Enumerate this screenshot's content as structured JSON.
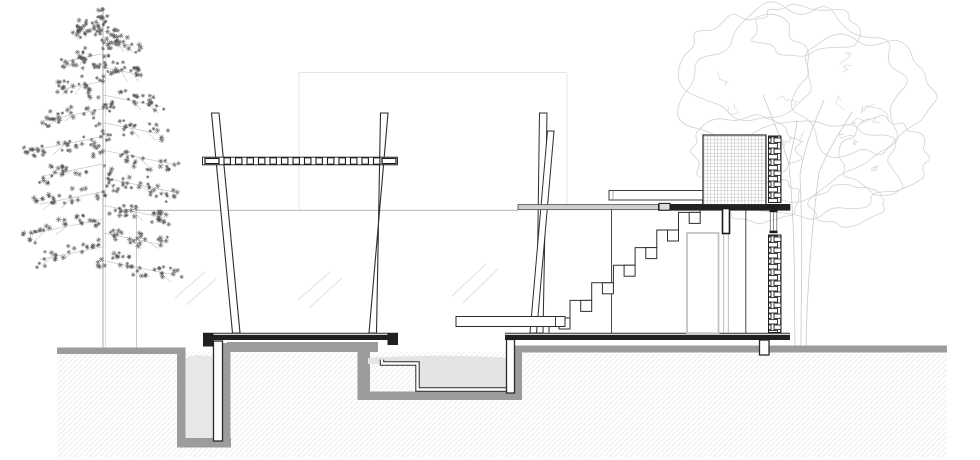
{
  "meta": {
    "title": "architectural-section-drawing",
    "canvas": {
      "width": 980,
      "height": 460,
      "background": "#ffffff"
    }
  },
  "palette": {
    "ink": "#2d2d2d",
    "slab_black": "#202020",
    "ground_gray": "#9c9c9c",
    "pit_fill": "#e7e7e7",
    "water_fill": "#e4e4e4",
    "slab_gray": "#cfcfcf",
    "frame_gray": "#c2c2c2",
    "faint_line": "#e4e4e4",
    "horizon_gray": "#b6b6b6",
    "tree_scatter": "#525252",
    "tree_sketch": "#d2d2d2",
    "hatch_gray": "#ededed"
  },
  "patterns": {
    "grid": {
      "size": 3.4,
      "stroke": "#8a8a8a",
      "width": 0.55
    },
    "brick": {
      "tile_w": 13,
      "tile_h": 11,
      "brick_w": 10,
      "brick_h": 4.4,
      "stroke": "#1f1f1f",
      "width": 0.9
    },
    "hatch": {
      "size": 5.2,
      "stroke": "#ededed",
      "width": 1.1
    }
  },
  "layers": [
    {
      "name": "background-references",
      "items": [
        {
          "n": "backdrop-rect-top-edge",
          "k": "line",
          "x1": 299,
          "y1": 72.5,
          "x2": 567,
          "y2": 72.5,
          "s": "#e4e4e4",
          "w": 1
        },
        {
          "n": "backdrop-rect-left-edge",
          "k": "line",
          "x1": 299,
          "y1": 72.5,
          "x2": 299,
          "y2": 210,
          "s": "#e4e4e4",
          "w": 1
        },
        {
          "n": "backdrop-rect-right-edge",
          "k": "line",
          "x1": 567,
          "y1": 72.5,
          "x2": 567,
          "y2": 210,
          "s": "#e4e4e4",
          "w": 1
        },
        {
          "n": "horizon-line",
          "k": "line",
          "x1": 136.5,
          "y1": 210.4,
          "x2": 518,
          "y2": 210.4,
          "s": "#b6b6b6",
          "w": 1
        },
        {
          "n": "fence-line",
          "k": "line",
          "x1": 136.5,
          "y1": 210.4,
          "x2": 136.5,
          "y2": 347.5,
          "s": "#c4c4c4",
          "w": 0.9
        },
        {
          "n": "reflection-mark",
          "k": "line",
          "x1": 175,
          "y1": 298,
          "x2": 205,
          "y2": 272,
          "s": "#e2e2e2",
          "w": 1
        },
        {
          "n": "reflection-mark",
          "k": "line",
          "x1": 186,
          "y1": 305,
          "x2": 216,
          "y2": 279,
          "s": "#e2e2e2",
          "w": 1
        },
        {
          "n": "reflection-mark",
          "k": "line",
          "x1": 298,
          "y1": 300,
          "x2": 330,
          "y2": 272,
          "s": "#e2e2e2",
          "w": 1
        },
        {
          "n": "reflection-mark",
          "k": "line",
          "x1": 309,
          "y1": 308,
          "x2": 342,
          "y2": 278,
          "s": "#e2e2e2",
          "w": 1
        },
        {
          "n": "reflection-mark",
          "k": "line",
          "x1": 452,
          "y1": 296,
          "x2": 486,
          "y2": 264,
          "s": "#e2e2e2",
          "w": 1
        },
        {
          "n": "reflection-mark",
          "k": "line",
          "x1": 463,
          "y1": 303,
          "x2": 498,
          "y2": 269,
          "s": "#e2e2e2",
          "w": 1
        }
      ]
    },
    {
      "name": "right-tree",
      "items": [
        {
          "n": "deciduous-tree",
          "k": "blobtree",
          "seed": 23,
          "loops": [
            [
              800,
              100,
              108,
              90
            ],
            [
              748,
              66,
              62,
              50
            ],
            [
              864,
              96,
              70,
              60
            ],
            [
              815,
              168,
              85,
              46
            ],
            [
              744,
              150,
              55,
              36
            ],
            [
              884,
              158,
              42,
              38
            ],
            [
              805,
              30,
              55,
              24
            ],
            [
              760,
              200,
              40,
              22
            ],
            [
              850,
              205,
              38,
              20
            ]
          ],
          "scribbles": {
            "count": 16,
            "cx": 810,
            "cy": 110,
            "rx": 100,
            "ry": 80
          },
          "trunks": [
            "M795,346 C794,290 796,240 789,165",
            "M801,346 C801,295 803,245 800,175",
            "M806,346 C807,290 812,225 819,172",
            "M789,165 C782,140 772,118 763,95",
            "M800,175 C804,148 812,128 824,100",
            "M819,172 C828,150 840,132 852,112",
            "M789,165 C791,150 796,135 797,120"
          ],
          "loop_stroke": "#d2d2d2",
          "trunk_stroke": "#c9c9c9"
        }
      ]
    },
    {
      "name": "left-tree",
      "items": [
        {
          "n": "conifer-tree",
          "k": "conifer",
          "seed": 11,
          "trunk_x": 103,
          "top_y": 8,
          "base_y": 347.5,
          "branches": 18,
          "first_y": 26,
          "step_y": 13.8,
          "branch_stroke": "#c6c6c6",
          "trunk_stroke": "#b8b8b8",
          "mark_stroke": "#525252"
        }
      ]
    },
    {
      "name": "subsoil",
      "items": [
        {
          "n": "subsoil-hatch",
          "k": "prect",
          "x": 57,
          "y": 352,
          "w": 890,
          "h": 105,
          "pat": "hatch",
          "bg": "none",
          "s": "none",
          "sw": 0
        }
      ]
    },
    {
      "name": "groundworks",
      "items": [
        {
          "n": "ground-band-left",
          "k": "rect",
          "x": 57,
          "y": 347.5,
          "w": 121,
          "h": 6.5,
          "f": "#9c9c9c"
        },
        {
          "n": "pit-wall-left",
          "k": "rect",
          "x": 177,
          "y": 347.5,
          "w": 8.5,
          "h": 99.5,
          "f": "#9c9c9c"
        },
        {
          "n": "pit-bottom",
          "k": "rect",
          "x": 177,
          "y": 438,
          "w": 54,
          "h": 9.5,
          "f": "#9c9c9c"
        },
        {
          "n": "pit-wall-right",
          "k": "rect",
          "x": 215.5,
          "y": 343,
          "w": 15,
          "h": 104,
          "f": "#9c9c9c"
        },
        {
          "n": "underdeck-ground-band",
          "k": "rect",
          "x": 227,
          "y": 342,
          "w": 151,
          "h": 10,
          "f": "#9c9c9c"
        },
        {
          "n": "pool-wall-left",
          "k": "rect",
          "x": 357.5,
          "y": 344,
          "w": 12.5,
          "h": 56,
          "f": "#9c9c9c"
        },
        {
          "n": "pool-bottom",
          "k": "rect",
          "x": 357.5,
          "y": 391.5,
          "w": 164.5,
          "h": 8.5,
          "f": "#9c9c9c"
        },
        {
          "n": "pool-wall-right",
          "k": "rect",
          "x": 512.5,
          "y": 346,
          "w": 9.5,
          "h": 54,
          "f": "#9c9c9c"
        },
        {
          "n": "ground-band-right",
          "k": "rect",
          "x": 515,
          "y": 345.5,
          "w": 432,
          "h": 7,
          "f": "#9c9c9c"
        },
        {
          "n": "pit-infill",
          "k": "path",
          "d": "M185.5,358 Q200,352.5 215.5,358 L215.5,438 L185.5,438 Z",
          "f": "#e7e7e7"
        },
        {
          "n": "pool-water",
          "k": "path",
          "d": "M368,358 Q440,353.5 510,358 L510,388 L419,388 L419,364 L368,364 Z",
          "f": "#e4e4e4"
        },
        {
          "n": "basin-liner",
          "k": "path",
          "d": "M382,359.5 L382,363.5 L417.5,363.5 L417.5,389.5 L510.5,389.5 L510.5,355.5",
          "passes": [
            [
              "#2b2b2b",
              4.4
            ],
            [
              "#ffffff",
              2.4
            ]
          ]
        }
      ]
    },
    {
      "name": "foundations",
      "items": [
        {
          "n": "deck-pile",
          "k": "rect",
          "x": 213.5,
          "y": 341,
          "w": 9,
          "h": 100,
          "f": "#ffffff",
          "s": "#2b2b2b",
          "sw": 1.3
        },
        {
          "n": "floor-pile",
          "k": "rect",
          "x": 506.5,
          "y": 339.5,
          "w": 8,
          "h": 53.5,
          "f": "#ffffff",
          "s": "#2b2b2b",
          "sw": 1.3
        },
        {
          "n": "strip-footing",
          "k": "rect",
          "x": 759.5,
          "y": 340,
          "w": 9.5,
          "h": 15,
          "f": "#ffffff",
          "s": "#2b2b2b",
          "sw": 1.3
        }
      ]
    },
    {
      "name": "pergola",
      "items": [
        {
          "n": "pergola-post-left",
          "k": "poly",
          "pts": [
            [
              211.5,
              113
            ],
            [
              219,
              113
            ],
            [
              240,
              333
            ],
            [
              232.5,
              333
            ]
          ],
          "f": "#ffffff",
          "s": "#2d2d2d",
          "sw": 1.1
        },
        {
          "n": "pergola-post-right",
          "k": "poly",
          "pts": [
            [
              380.5,
              113
            ],
            [
              388,
              113
            ],
            [
              369,
              333
            ],
            [
              376.5,
              333
            ]
          ],
          "f": "#ffffff",
          "s": "#2d2d2d",
          "sw": 1.1
        },
        {
          "n": "pergola-beam",
          "k": "rect",
          "x": 202.5,
          "y": 157.2,
          "w": 195,
          "h": 7.6,
          "f": "#ffffff",
          "s": "#2d2d2d",
          "sw": 1
        },
        {
          "n": "pergola-beam-end-left",
          "k": "rect",
          "x": 205,
          "y": 158.4,
          "w": 14,
          "h": 5.2,
          "f": "#ffffff",
          "s": "#1c1c1c",
          "sw": 1.2
        },
        {
          "n": "pergola-beam-end-right",
          "k": "rect",
          "x": 382,
          "y": 158.4,
          "w": 14,
          "h": 5.2,
          "f": "#ffffff",
          "s": "#1c1c1c",
          "sw": 1.2
        },
        {
          "n": "pergola-rafters",
          "k": "sqrow",
          "x0": 224,
          "step": 11.5,
          "count": 14,
          "yc": 161,
          "size": 6.4,
          "s": "#1c1c1c",
          "sw": 1.1
        }
      ]
    },
    {
      "name": "diagonal-struts",
      "items": [
        {
          "n": "strut-a",
          "k": "poly",
          "pts": [
            [
              539.5,
              113
            ],
            [
              547,
              113
            ],
            [
              543,
              333
            ],
            [
              536.5,
              333
            ]
          ],
          "f": "#ffffff",
          "s": "#2d2d2d",
          "sw": 1
        },
        {
          "n": "strut-b",
          "k": "poly",
          "pts": [
            [
              547.5,
              131
            ],
            [
              554,
              131
            ],
            [
              536.5,
              333
            ],
            [
              530,
              333
            ]
          ],
          "f": "#ffffff",
          "s": "#2d2d2d",
          "sw": 1
        }
      ]
    },
    {
      "name": "slabs",
      "items": [
        {
          "n": "deck-slab-top-line",
          "k": "line",
          "x1": 203,
          "y1": 333.2,
          "x2": 398,
          "y2": 333.2,
          "s": "#2b2b2b",
          "w": 1
        },
        {
          "n": "deck-slab",
          "k": "rect",
          "x": 203,
          "y": 334.8,
          "w": 195,
          "h": 5.2,
          "f": "#202020"
        },
        {
          "n": "deck-end-cap-left",
          "k": "rect",
          "x": 203,
          "y": 333,
          "w": 10.5,
          "h": 13.5,
          "f": "#202020"
        },
        {
          "n": "deck-end-cap-right",
          "k": "rect",
          "x": 387.5,
          "y": 333,
          "w": 10.5,
          "h": 12,
          "f": "#202020"
        },
        {
          "n": "floor-slab-top-line",
          "k": "line",
          "x1": 505,
          "y1": 333.2,
          "x2": 790,
          "y2": 333.2,
          "s": "#2b2b2b",
          "w": 1
        },
        {
          "n": "floor-slab",
          "k": "rect",
          "x": 505,
          "y": 334.8,
          "w": 285,
          "h": 5.2,
          "f": "#202020"
        }
      ]
    },
    {
      "name": "pavilion",
      "items": [
        {
          "n": "stair-wall-line",
          "k": "line",
          "x1": 611.5,
          "y1": 209.6,
          "x2": 611.5,
          "y2": 333,
          "s": "#4a4a4a",
          "w": 1
        },
        {
          "n": "door-frame",
          "k": "rect",
          "x": 687,
          "y": 233,
          "w": 31.5,
          "h": 100.2,
          "f": "none",
          "s": "#c2c2c2",
          "sw": 1.8
        },
        {
          "n": "glazing-line",
          "k": "line",
          "x1": 723.6,
          "y1": 233.5,
          "x2": 723.6,
          "y2": 333,
          "s": "#bdbdbd",
          "w": 1
        },
        {
          "n": "glazing-line",
          "k": "line",
          "x1": 728.4,
          "y1": 233.5,
          "x2": 728.4,
          "y2": 333,
          "s": "#bdbdbd",
          "w": 1
        },
        {
          "n": "interior-wall-line",
          "k": "line",
          "x1": 745.8,
          "y1": 209.6,
          "x2": 745.8,
          "y2": 333,
          "s": "#4a4a4a",
          "w": 1
        },
        {
          "n": "upper-slab",
          "k": "rect",
          "x": 518,
          "y": 204.6,
          "w": 272,
          "h": 5,
          "f": "#cfcfcf",
          "s": "#5a5a5a",
          "sw": 0.9
        },
        {
          "n": "upper-slab-dark",
          "k": "rect",
          "x": 658,
          "y": 204,
          "w": 132,
          "h": 6.6,
          "f": "#202020"
        },
        {
          "n": "slab-joint-box",
          "k": "rect",
          "x": 659,
          "y": 203.4,
          "w": 11,
          "h": 6.8,
          "f": "#dcdcdc",
          "s": "#1c1c1c",
          "sw": 1.1
        },
        {
          "n": "parapet",
          "k": "rect",
          "x": 609,
          "y": 190.5,
          "w": 96,
          "h": 9.5,
          "f": "#ffffff",
          "s": "#3d3d3d",
          "sw": 1
        },
        {
          "n": "parapet-inner-line",
          "k": "line",
          "x1": 613,
          "y1": 191,
          "x2": 613,
          "y2": 200,
          "s": "#8a8a8a",
          "w": 0.7
        },
        {
          "n": "parapet-connector",
          "k": "line",
          "x1": 702.5,
          "y1": 200,
          "x2": 702.5,
          "y2": 204.6,
          "s": "#3d3d3d",
          "w": 0.8
        },
        {
          "n": "parapet-connector",
          "k": "line",
          "x1": 705,
          "y1": 200,
          "x2": 705,
          "y2": 204.6,
          "s": "#3d3d3d",
          "w": 0.8
        },
        {
          "n": "edge-beam",
          "k": "rect",
          "x": 722.5,
          "y": 208.5,
          "w": 7,
          "h": 25,
          "f": "#ffffff",
          "s": "#1a1a1a",
          "sw": 1.6
        },
        {
          "n": "clerestory-head",
          "k": "rect",
          "x": 769.5,
          "y": 209.8,
          "w": 8,
          "h": 2.4,
          "f": "#1a1a1a"
        },
        {
          "n": "clerestory-sill",
          "k": "rect",
          "x": 769.5,
          "y": 230.6,
          "w": 8,
          "h": 2.6,
          "f": "#1a1a1a"
        },
        {
          "n": "clerestory-glass",
          "k": "line",
          "x1": 770.3,
          "y1": 212.2,
          "x2": 770.3,
          "y2": 230.6,
          "s": "#6a6a6a",
          "w": 0.8
        },
        {
          "n": "clerestory-glass",
          "k": "line",
          "x1": 773.5,
          "y1": 212.2,
          "x2": 773.5,
          "y2": 230.6,
          "s": "#6a6a6a",
          "w": 0.8
        },
        {
          "n": "clerestory-glass",
          "k": "line",
          "x1": 776.8,
          "y1": 212.2,
          "x2": 776.8,
          "y2": 230.6,
          "s": "#6a6a6a",
          "w": 0.8
        },
        {
          "n": "mesh-screen-block",
          "k": "prect",
          "x": 703,
          "y": 135,
          "w": 63,
          "h": 69.6,
          "pat": "grid",
          "bg": "#ffffff",
          "s": "#2d2d2d",
          "sw": 1.2
        },
        {
          "n": "brick-pier-upper",
          "k": "prect",
          "x": 768.5,
          "y": 136,
          "w": 12.5,
          "h": 66.5,
          "pat": "brick",
          "bg": "#ffffff",
          "s": "#1f1f1f",
          "sw": 1
        },
        {
          "n": "brick-pier-lower",
          "k": "prect",
          "x": 768.5,
          "y": 235,
          "w": 12.5,
          "h": 97.5,
          "pat": "brick",
          "bg": "#ffffff",
          "s": "#1f1f1f",
          "sw": 1
        }
      ]
    },
    {
      "name": "staircase",
      "items": [
        {
          "n": "stair-profile",
          "k": "path",
          "f": "none",
          "s": "#2d2d2d",
          "sw": 1,
          "d": "M549,333 L549,318 L570,318 L570,300.4 L591.7,300.4 L591.7,282.8 L613.4,282.8 L613.4,265.2 L635.1,265.2 L635.1,247.6 L656.8,247.6 L656.8,230 L678.5,230 L678.5,212.4 L700.2,212.4 L700.2,204.8"
        },
        {
          "n": "stair-stringer-blocks",
          "k": "squares",
          "size": 11,
          "f": "#ffffff",
          "s": "#2d2d2d",
          "sw": 1,
          "pts": [
            [
              559,
              318
            ],
            [
              580.7,
              300.4
            ],
            [
              602.4,
              282.8
            ],
            [
              624.1,
              265.2
            ],
            [
              645.8,
              247.6
            ],
            [
              667.5,
              230
            ],
            [
              689.2,
              212.4
            ]
          ]
        }
      ]
    },
    {
      "name": "bench",
      "items": [
        {
          "n": "bench-plank",
          "k": "rect",
          "x": 456,
          "y": 316.5,
          "w": 109,
          "h": 10,
          "f": "#ffffff",
          "s": "#2d2d2d",
          "sw": 1
        },
        {
          "n": "bench-end-tick",
          "k": "line",
          "x1": 555.5,
          "y1": 316.5,
          "x2": 555.5,
          "y2": 326.5,
          "s": "#2d2d2d",
          "w": 0.9
        }
      ]
    }
  ]
}
